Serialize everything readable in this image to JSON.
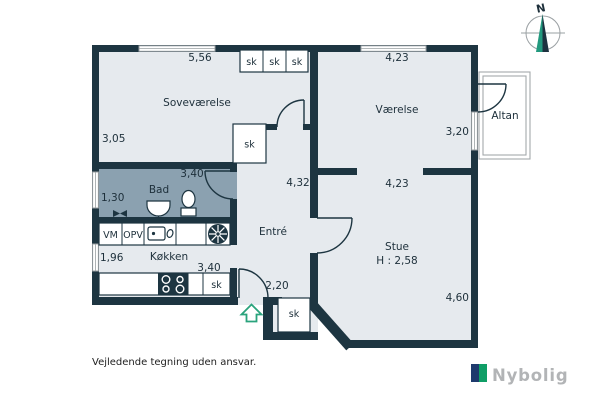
{
  "colors": {
    "wall": "#1d3541",
    "floor": "#e6eaee",
    "bad_floor": "#8ba1b0",
    "window": "#9aa0a3",
    "balcony": "#a4a8ab",
    "text": "#1d2f3a",
    "entrance_arrow": "#2aa37c",
    "compass_teal": "#22997e",
    "compass_navy": "#1d3240",
    "brand_navy": "#1e3a6d",
    "brand_green": "#0f9e66",
    "brand_text": "#b2b4b6"
  },
  "rooms": {
    "sovevaerelse": {
      "label": "Soveværelse",
      "width": "5,56",
      "depth": "3,05"
    },
    "vaerelse": {
      "label": "Værelse",
      "width": "4,23",
      "depth": "3,20"
    },
    "bad": {
      "label": "Bad",
      "width": "3,40",
      "depth": "1,30"
    },
    "entre": {
      "label": "Entré",
      "length": "4,32",
      "hall_width": "2,20"
    },
    "koekken": {
      "label": "Køkken",
      "width": "3,40",
      "depth": "1,96"
    },
    "stue": {
      "label": "Stue",
      "ceiling_height": "H : 2,58",
      "width": "4,23",
      "depth": "4,60"
    },
    "altan": {
      "label": "Altan"
    }
  },
  "fixtures": {
    "closet": "sk",
    "washing_machine": "VM",
    "dishwasher": "OPV"
  },
  "compass": {
    "north": "N"
  },
  "footer": {
    "disclaimer": "Vejledende tegning uden ansvar.",
    "brand": "Nybolig"
  }
}
